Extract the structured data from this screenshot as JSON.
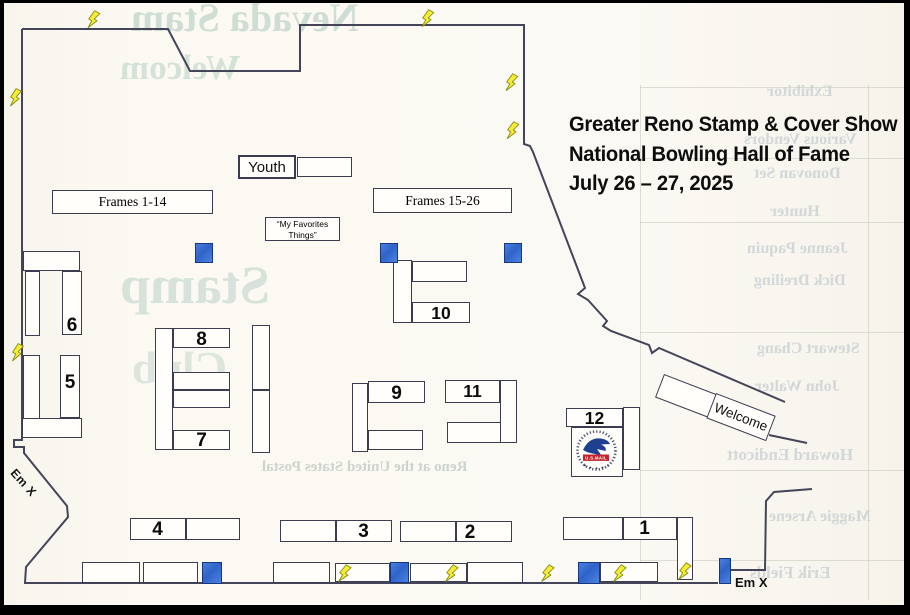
{
  "title": {
    "line1": "Greater Reno Stamp & Cover Show",
    "line2": "National Bowling Hall of Fame",
    "line3": "July 26 – 27, 2025"
  },
  "areas": {
    "youth": "Youth",
    "frames_left": "Frames 1-14",
    "frames_right": "Frames 15-26",
    "favorites_line1": "“My Favorites",
    "favorites_line2": "Things”",
    "welcome": "Welcome"
  },
  "exits": {
    "left_label": "Em X",
    "right_label": "Em X"
  },
  "booths": {
    "b1": "1",
    "b2": "2",
    "b3": "3",
    "b4": "4",
    "b5": "5",
    "b6": "6",
    "b7": "7",
    "b8": "8",
    "b9": "9",
    "b10": "10",
    "b11": "11",
    "b12": "12"
  },
  "usps_logo": {
    "mail_bar": "U.S.MAIL"
  },
  "colors": {
    "wall": "#3c3c50",
    "table_border": "#3c3c50",
    "marker_blue": "#356fd0",
    "bolt_yellow": "#f3ee35",
    "title_text": "#0d0d0d",
    "paper": "#fbf9f2"
  },
  "ghost_bleedthrough": {
    "big_words": [
      "Nevada Stam",
      "Welcom",
      "Stamp",
      "Club"
    ],
    "names": [
      "Exhibitor",
      "Various Vendors",
      "Donovan Set",
      "Hunter",
      "Jeanne Paquin",
      "Dick Dreiling",
      "Stewart Chang",
      "John Walter",
      "Howard Endicott",
      "Maggie Arsene",
      "Erik Fields"
    ],
    "bottom_line": "Reno at the United States Postal"
  }
}
